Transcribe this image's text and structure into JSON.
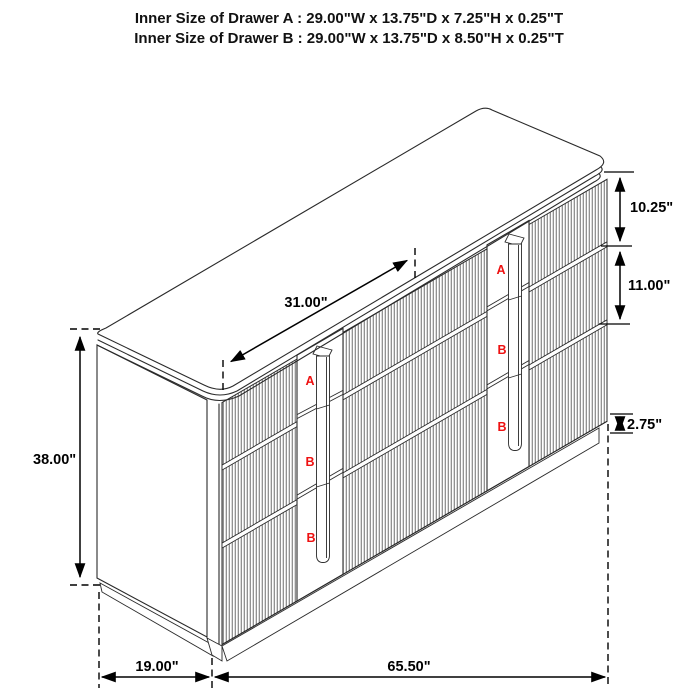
{
  "header": {
    "line1": "Inner Size of Drawer A : 29.00\"W x 13.75\"D x 7.25\"H x 0.25\"T",
    "line2": "Inner Size of Drawer B : 29.00\"W x 13.75\"D x 8.50\"H x 0.25\"T"
  },
  "dimensions": {
    "middle_drawer_width": "31.00\"",
    "drawer_a_front_height": "10.25\"",
    "drawer_b_front_height": "11.00\"",
    "base_height": "2.75\"",
    "overall_height": "38.00\"",
    "side_depth": "19.00\"",
    "overall_width": "65.50\""
  },
  "drawer_labels": {
    "left_column": [
      "A",
      "B",
      "B"
    ],
    "right_column": [
      "A",
      "B",
      "B"
    ]
  },
  "colors": {
    "line": "#2a2a2a",
    "dimension": "#000000",
    "label_red": "#ee1111",
    "flute": "#484848",
    "background": "#ffffff"
  }
}
